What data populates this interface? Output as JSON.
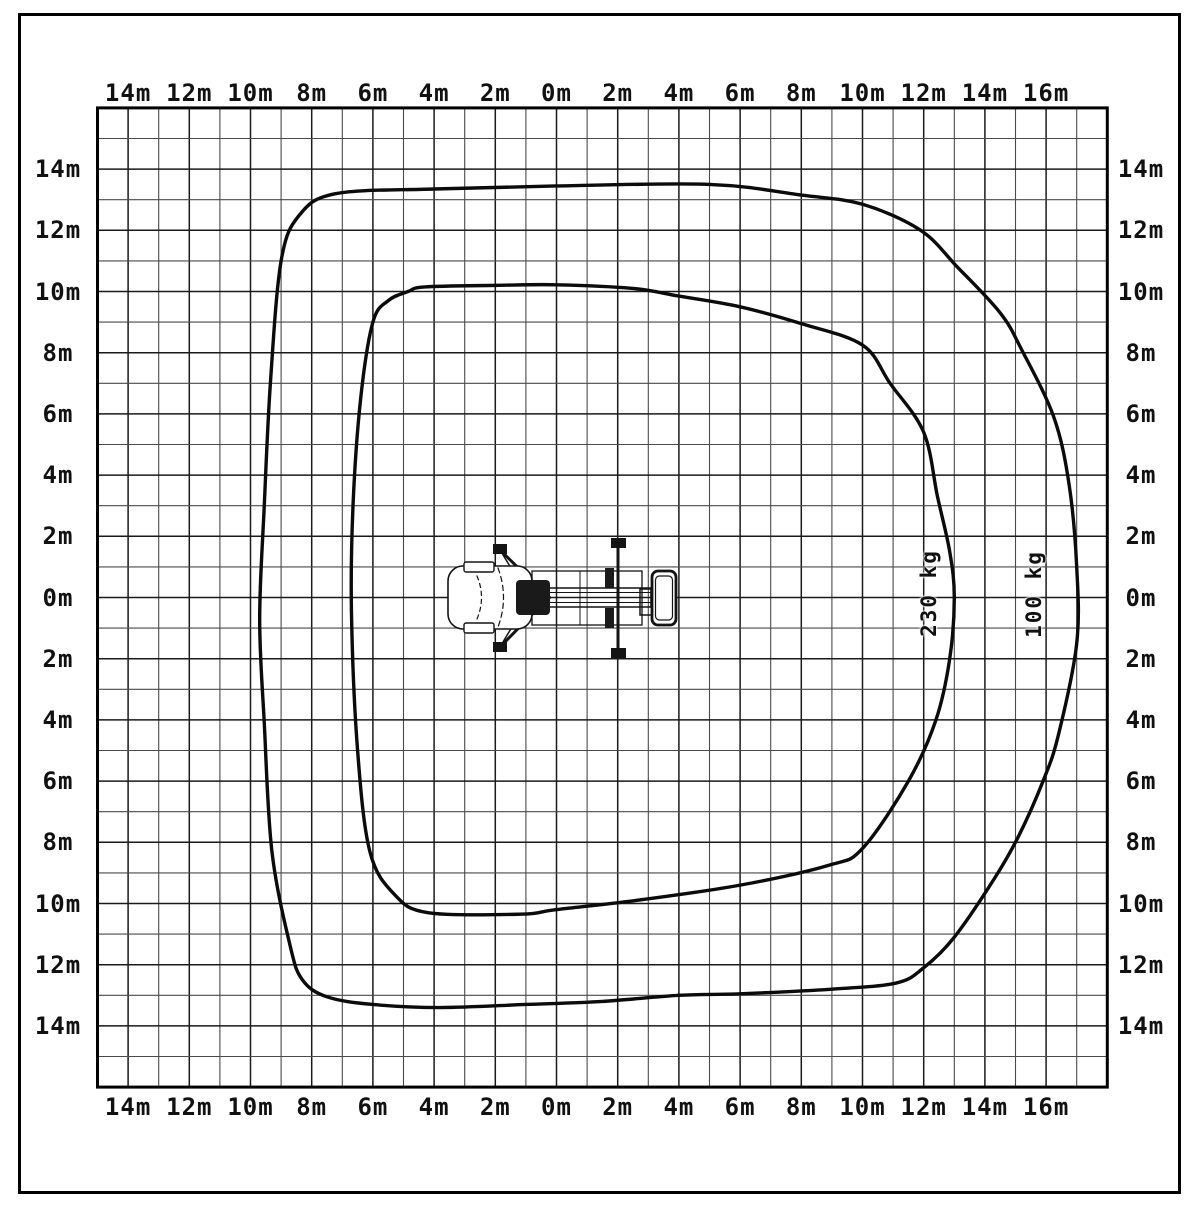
{
  "diagram": {
    "kind": "aerial-platform-working-range-top-view",
    "vehicle_icon": "truck-mounted-aerial-platform-top-view"
  },
  "axes": {
    "unit": "m",
    "top": {
      "labels": [
        "14m",
        "12m",
        "10m",
        "8m",
        "6m",
        "4m",
        "2m",
        "0m",
        "2m",
        "4m",
        "6m",
        "8m",
        "10m",
        "12m",
        "14m",
        "16m"
      ]
    },
    "bottom": {
      "labels": [
        "14m",
        "12m",
        "10m",
        "8m",
        "6m",
        "4m",
        "2m",
        "0m",
        "2m",
        "4m",
        "6m",
        "8m",
        "10m",
        "12m",
        "14m",
        "16m"
      ]
    },
    "left": {
      "labels": [
        "14m",
        "12m",
        "10m",
        "8m",
        "6m",
        "4m",
        "2m",
        "0m",
        "2m",
        "4m",
        "6m",
        "8m",
        "10m",
        "12m",
        "14m"
      ]
    },
    "right": {
      "labels": [
        "14m",
        "12m",
        "10m",
        "8m",
        "6m",
        "4m",
        "2m",
        "0m",
        "2m",
        "4m",
        "6m",
        "8m",
        "10m",
        "12m",
        "14m"
      ]
    }
  },
  "curves": {
    "inner": {
      "label": "230 kg"
    },
    "outer": {
      "label": "100 kg"
    }
  },
  "colors": {
    "background": "#ffffff",
    "frame": "#000000",
    "grid_minor": "#4a4a4a",
    "grid_major": "#1a1a1a",
    "curve": "#0b0b0b",
    "text": "#111111"
  },
  "chart_data": {
    "type": "area",
    "title": "",
    "xlabel": "m",
    "ylabel": "m",
    "x_range_m": [
      -15,
      18
    ],
    "y_range_m": [
      -16,
      16
    ],
    "grid_step_m": 1,
    "label_step_m": 2,
    "grid": "on",
    "series": [
      {
        "name": "230 kg",
        "points": [
          [
            -6.65,
            3.0
          ],
          [
            -6.4,
            6.5
          ],
          [
            -6.0,
            9.0
          ],
          [
            -5.5,
            9.7
          ],
          [
            -4.85,
            10.0
          ],
          [
            -4.3,
            10.15
          ],
          [
            -2.0,
            10.2
          ],
          [
            0.0,
            10.22
          ],
          [
            2.5,
            10.1
          ],
          [
            4.0,
            9.85
          ],
          [
            6.0,
            9.5
          ],
          [
            8.0,
            8.95
          ],
          [
            10.0,
            8.25
          ],
          [
            10.9,
            7.0
          ],
          [
            12.0,
            5.4
          ],
          [
            12.45,
            3.3
          ],
          [
            12.85,
            1.5
          ],
          [
            13.0,
            0.0
          ],
          [
            12.85,
            -2.0
          ],
          [
            12.4,
            -4.0
          ],
          [
            11.5,
            -6.0
          ],
          [
            10.0,
            -8.2
          ],
          [
            8.9,
            -8.75
          ],
          [
            6.0,
            -9.4
          ],
          [
            2.6,
            -9.9
          ],
          [
            0.0,
            -10.2
          ],
          [
            -1.2,
            -10.35
          ],
          [
            -4.2,
            -10.3
          ],
          [
            -5.3,
            -9.7
          ],
          [
            -6.1,
            -8.3
          ],
          [
            -6.5,
            -5.0
          ],
          [
            -6.7,
            -0.5
          ]
        ]
      },
      {
        "name": "100 kg",
        "points": [
          [
            -9.35,
            7.0
          ],
          [
            -9.0,
            11.0
          ],
          [
            -8.4,
            12.5
          ],
          [
            -7.2,
            13.2
          ],
          [
            -4.0,
            13.35
          ],
          [
            0.0,
            13.45
          ],
          [
            5.0,
            13.5
          ],
          [
            8.0,
            13.15
          ],
          [
            10.0,
            12.85
          ],
          [
            11.9,
            12.0
          ],
          [
            13.1,
            10.8
          ],
          [
            14.5,
            9.3
          ],
          [
            15.2,
            8.1
          ],
          [
            16.25,
            5.9
          ],
          [
            16.75,
            3.7
          ],
          [
            17.0,
            1.0
          ],
          [
            17.0,
            -1.5
          ],
          [
            16.4,
            -4.5
          ],
          [
            15.9,
            -6.0
          ],
          [
            15.1,
            -7.8
          ],
          [
            14.3,
            -9.2
          ],
          [
            13.0,
            -11.1
          ],
          [
            12.0,
            -12.1
          ],
          [
            11.1,
            -12.6
          ],
          [
            9.0,
            -12.8
          ],
          [
            6.0,
            -12.95
          ],
          [
            4.0,
            -13.0
          ],
          [
            1.5,
            -13.2
          ],
          [
            -1.0,
            -13.3
          ],
          [
            -3.8,
            -13.4
          ],
          [
            -6.0,
            -13.3
          ],
          [
            -7.5,
            -13.05
          ],
          [
            -8.3,
            -12.5
          ],
          [
            -8.7,
            -11.4
          ],
          [
            -9.3,
            -8.3
          ],
          [
            -9.55,
            -4.1
          ],
          [
            -9.7,
            -0.7
          ],
          [
            -9.55,
            3.0
          ]
        ]
      }
    ]
  }
}
